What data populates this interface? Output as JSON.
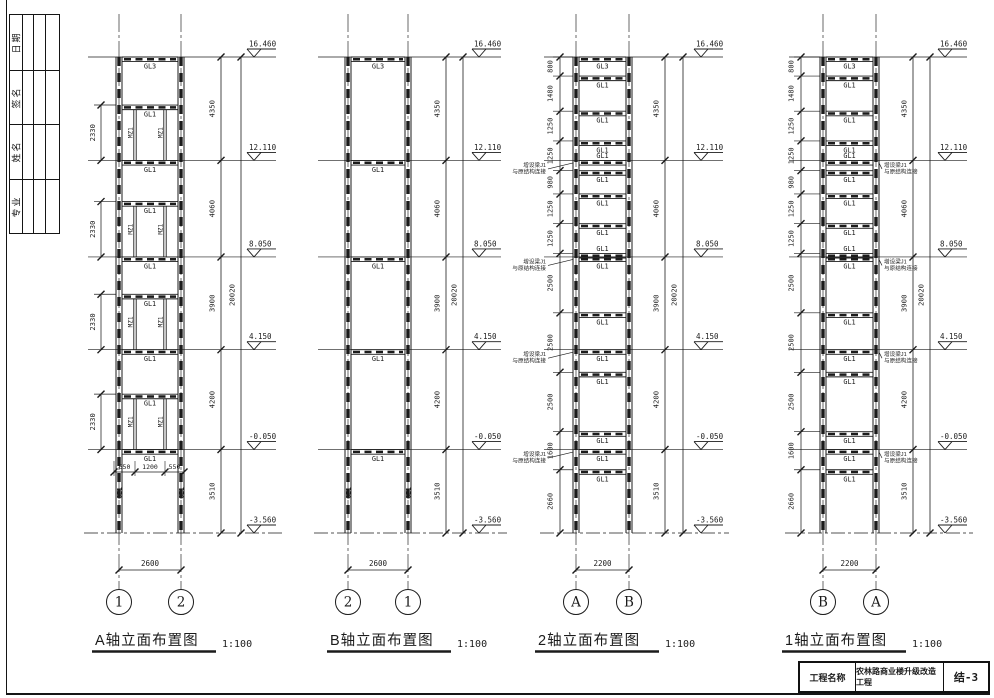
{
  "sheet": {
    "signature_strip": {
      "labels": [
        "日期",
        "签名",
        "姓名",
        "专业"
      ]
    },
    "title_block": {
      "name_label": "工程名称",
      "project": "农林路商业楼升级改造工程",
      "drawing_no": "结-3"
    }
  },
  "drawing": {
    "ink": "#1b1b1b",
    "elevations": [
      {
        "mm": 16460,
        "label": "16.460"
      },
      {
        "mm": 12110,
        "label": "12.110"
      },
      {
        "mm": 8050,
        "label": "8.050"
      },
      {
        "mm": 4150,
        "label": "4.150"
      },
      {
        "mm": -50,
        "label": "-0.050"
      },
      {
        "mm": -3560,
        "label": "-3.560"
      }
    ],
    "story_dims": [
      {
        "label": "4350",
        "top": 16460,
        "bot": 12110
      },
      {
        "label": "4060",
        "top": 12110,
        "bot": 8050
      },
      {
        "label": "3900",
        "top": 8050,
        "bot": 4150
      },
      {
        "label": "4200",
        "top": 4150,
        "bot": -50
      },
      {
        "label": "3510",
        "top": -50,
        "bot": -3560
      }
    ],
    "overall_dim": {
      "label": "20020",
      "top": 16460,
      "bot": -3560
    },
    "annotation_lines": [
      "增设梁J1",
      "与原结构连接"
    ],
    "views": [
      {
        "id": "A",
        "title": "A轴立面布置图",
        "scale": "1:100",
        "axis_bubbles": [
          "1",
          "2"
        ],
        "width_dim": "2600",
        "beams": [
          {
            "mm": 16460,
            "label": "GL3"
          },
          {
            "mm": 14440,
            "label": "GL1"
          },
          {
            "mm": 12110,
            "label": "GL1"
          },
          {
            "mm": 10380,
            "label": "GL1"
          },
          {
            "mm": 8050,
            "label": "GL1"
          },
          {
            "mm": 6480,
            "label": "GL1"
          },
          {
            "mm": 4150,
            "label": "GL1"
          },
          {
            "mm": 2280,
            "label": "GL1"
          },
          {
            "mm": -50,
            "label": "GL1"
          }
        ],
        "posts": {
          "label": "MZ1",
          "stories": [
            {
              "top": 14440,
              "bot": 12110
            },
            {
              "top": 10380,
              "bot": 8050
            },
            {
              "top": 6480,
              "bot": 4150
            },
            {
              "top": 2280,
              "bot": -50
            }
          ]
        },
        "left_dims": [
          {
            "label": "2330",
            "top": 14440,
            "bot": 12110
          },
          {
            "label": "2330",
            "top": 10380,
            "bot": 8050
          },
          {
            "label": "2330",
            "top": 6480,
            "bot": 4150
          },
          {
            "label": "2330",
            "top": 2280,
            "bot": -50
          }
        ],
        "sub_dims": [
          "650",
          "1200",
          "550"
        ],
        "column_label": "GZ1"
      },
      {
        "id": "B",
        "title": "B轴立面布置图",
        "scale": "1:100",
        "axis_bubbles": [
          "2",
          "1"
        ],
        "width_dim": "2600",
        "beams": [
          {
            "mm": 16460,
            "label": "GL3"
          },
          {
            "mm": 12110,
            "label": "GL1"
          },
          {
            "mm": 8050,
            "label": "GL1"
          },
          {
            "mm": 4150,
            "label": "GL1"
          },
          {
            "mm": -50,
            "label": "GL1"
          }
        ],
        "column_label": "GZ1"
      },
      {
        "id": "2",
        "title": "2轴立面布置图",
        "scale": "1:100",
        "axis_bubbles": [
          "A",
          "B"
        ],
        "width_dim": "2200",
        "annotation_side": "left",
        "beams": [
          {
            "mm": 16460,
            "label": "GL3",
            "pos": "below"
          },
          {
            "mm": 15660,
            "label": "GL1",
            "pos": "below"
          },
          {
            "mm": 14180,
            "label": "GL1",
            "pos": "below"
          },
          {
            "mm": 12930,
            "label": "GL1",
            "pos": "below"
          },
          {
            "mm": 12110,
            "label": "GL1",
            "pos": "above",
            "annotated": true
          },
          {
            "mm": 11680,
            "label": "GL1",
            "pos": "below"
          },
          {
            "mm": 10700,
            "label": "GL1",
            "pos": "below"
          },
          {
            "mm": 9450,
            "label": "GL1",
            "pos": "below"
          },
          {
            "mm": 8200,
            "label": "GL1",
            "pos": "above"
          },
          {
            "mm": 8050,
            "label": "GL1",
            "pos": "below",
            "annotated": true
          },
          {
            "mm": 5700,
            "label": "GL1",
            "pos": "below"
          },
          {
            "mm": 4150,
            "label": "GL1",
            "pos": "below",
            "annotated": true
          },
          {
            "mm": 3200,
            "label": "GL1",
            "pos": "below"
          },
          {
            "mm": 700,
            "label": "GL1",
            "pos": "below"
          },
          {
            "mm": -50,
            "label": "GL1",
            "pos": "below",
            "annotated": true
          },
          {
            "mm": -900,
            "label": "GL1",
            "pos": "below"
          }
        ],
        "left_chain": [
          {
            "label": "800",
            "top": 16460,
            "bot": 15660
          },
          {
            "label": "1480",
            "top": 15660,
            "bot": 14180
          },
          {
            "label": "1250",
            "top": 14180,
            "bot": 12930
          },
          {
            "label": "1250",
            "top": 12930,
            "bot": 11680
          },
          {
            "label": "980",
            "top": 11680,
            "bot": 10700
          },
          {
            "label": "1250",
            "top": 10700,
            "bot": 9450
          },
          {
            "label": "1250",
            "top": 9450,
            "bot": 8200
          },
          {
            "label": "2500",
            "top": 8200,
            "bot": 5700
          },
          {
            "label": "2500",
            "top": 5700,
            "bot": 3200
          },
          {
            "label": "2500",
            "top": 3200,
            "bot": 700
          },
          {
            "label": "1600",
            "top": 700,
            "bot": -900
          },
          {
            "label": "2660",
            "top": -900,
            "bot": -3560
          }
        ]
      },
      {
        "id": "1",
        "title": "1轴立面布置图",
        "scale": "1:100",
        "axis_bubbles": [
          "B",
          "A"
        ],
        "width_dim": "2200",
        "annotation_side": "right",
        "beams": [
          {
            "mm": 16460,
            "label": "GL3",
            "pos": "below"
          },
          {
            "mm": 15660,
            "label": "GL1",
            "pos": "below"
          },
          {
            "mm": 14180,
            "label": "GL1",
            "pos": "below"
          },
          {
            "mm": 12930,
            "label": "GL1",
            "pos": "below"
          },
          {
            "mm": 12110,
            "label": "GL1",
            "pos": "above",
            "annotated": true
          },
          {
            "mm": 11680,
            "label": "GL1",
            "pos": "below"
          },
          {
            "mm": 10700,
            "label": "GL1",
            "pos": "below"
          },
          {
            "mm": 9450,
            "label": "GL1",
            "pos": "below"
          },
          {
            "mm": 8200,
            "label": "GL1",
            "pos": "above"
          },
          {
            "mm": 8050,
            "label": "GL1",
            "pos": "below",
            "annotated": true
          },
          {
            "mm": 5700,
            "label": "GL1",
            "pos": "below"
          },
          {
            "mm": 4150,
            "label": "GL1",
            "pos": "below",
            "annotated": true
          },
          {
            "mm": 3200,
            "label": "GL1",
            "pos": "below"
          },
          {
            "mm": 700,
            "label": "GL1",
            "pos": "below"
          },
          {
            "mm": -50,
            "label": "GL1",
            "pos": "below",
            "annotated": true
          },
          {
            "mm": -900,
            "label": "GL1",
            "pos": "below"
          }
        ],
        "left_chain": [
          {
            "label": "800",
            "top": 16460,
            "bot": 15660
          },
          {
            "label": "1480",
            "top": 15660,
            "bot": 14180
          },
          {
            "label": "1250",
            "top": 14180,
            "bot": 12930
          },
          {
            "label": "1250",
            "top": 12930,
            "bot": 11680
          },
          {
            "label": "980",
            "top": 11680,
            "bot": 10700
          },
          {
            "label": "1250",
            "top": 10700,
            "bot": 9450
          },
          {
            "label": "1250",
            "top": 9450,
            "bot": 8200
          },
          {
            "label": "2500",
            "top": 8200,
            "bot": 5700
          },
          {
            "label": "2500",
            "top": 5700,
            "bot": 3200
          },
          {
            "label": "2500",
            "top": 3200,
            "bot": 700
          },
          {
            "label": "1600",
            "top": 700,
            "bot": -900
          },
          {
            "label": "2660",
            "top": -900,
            "bot": -3560
          }
        ]
      }
    ]
  }
}
